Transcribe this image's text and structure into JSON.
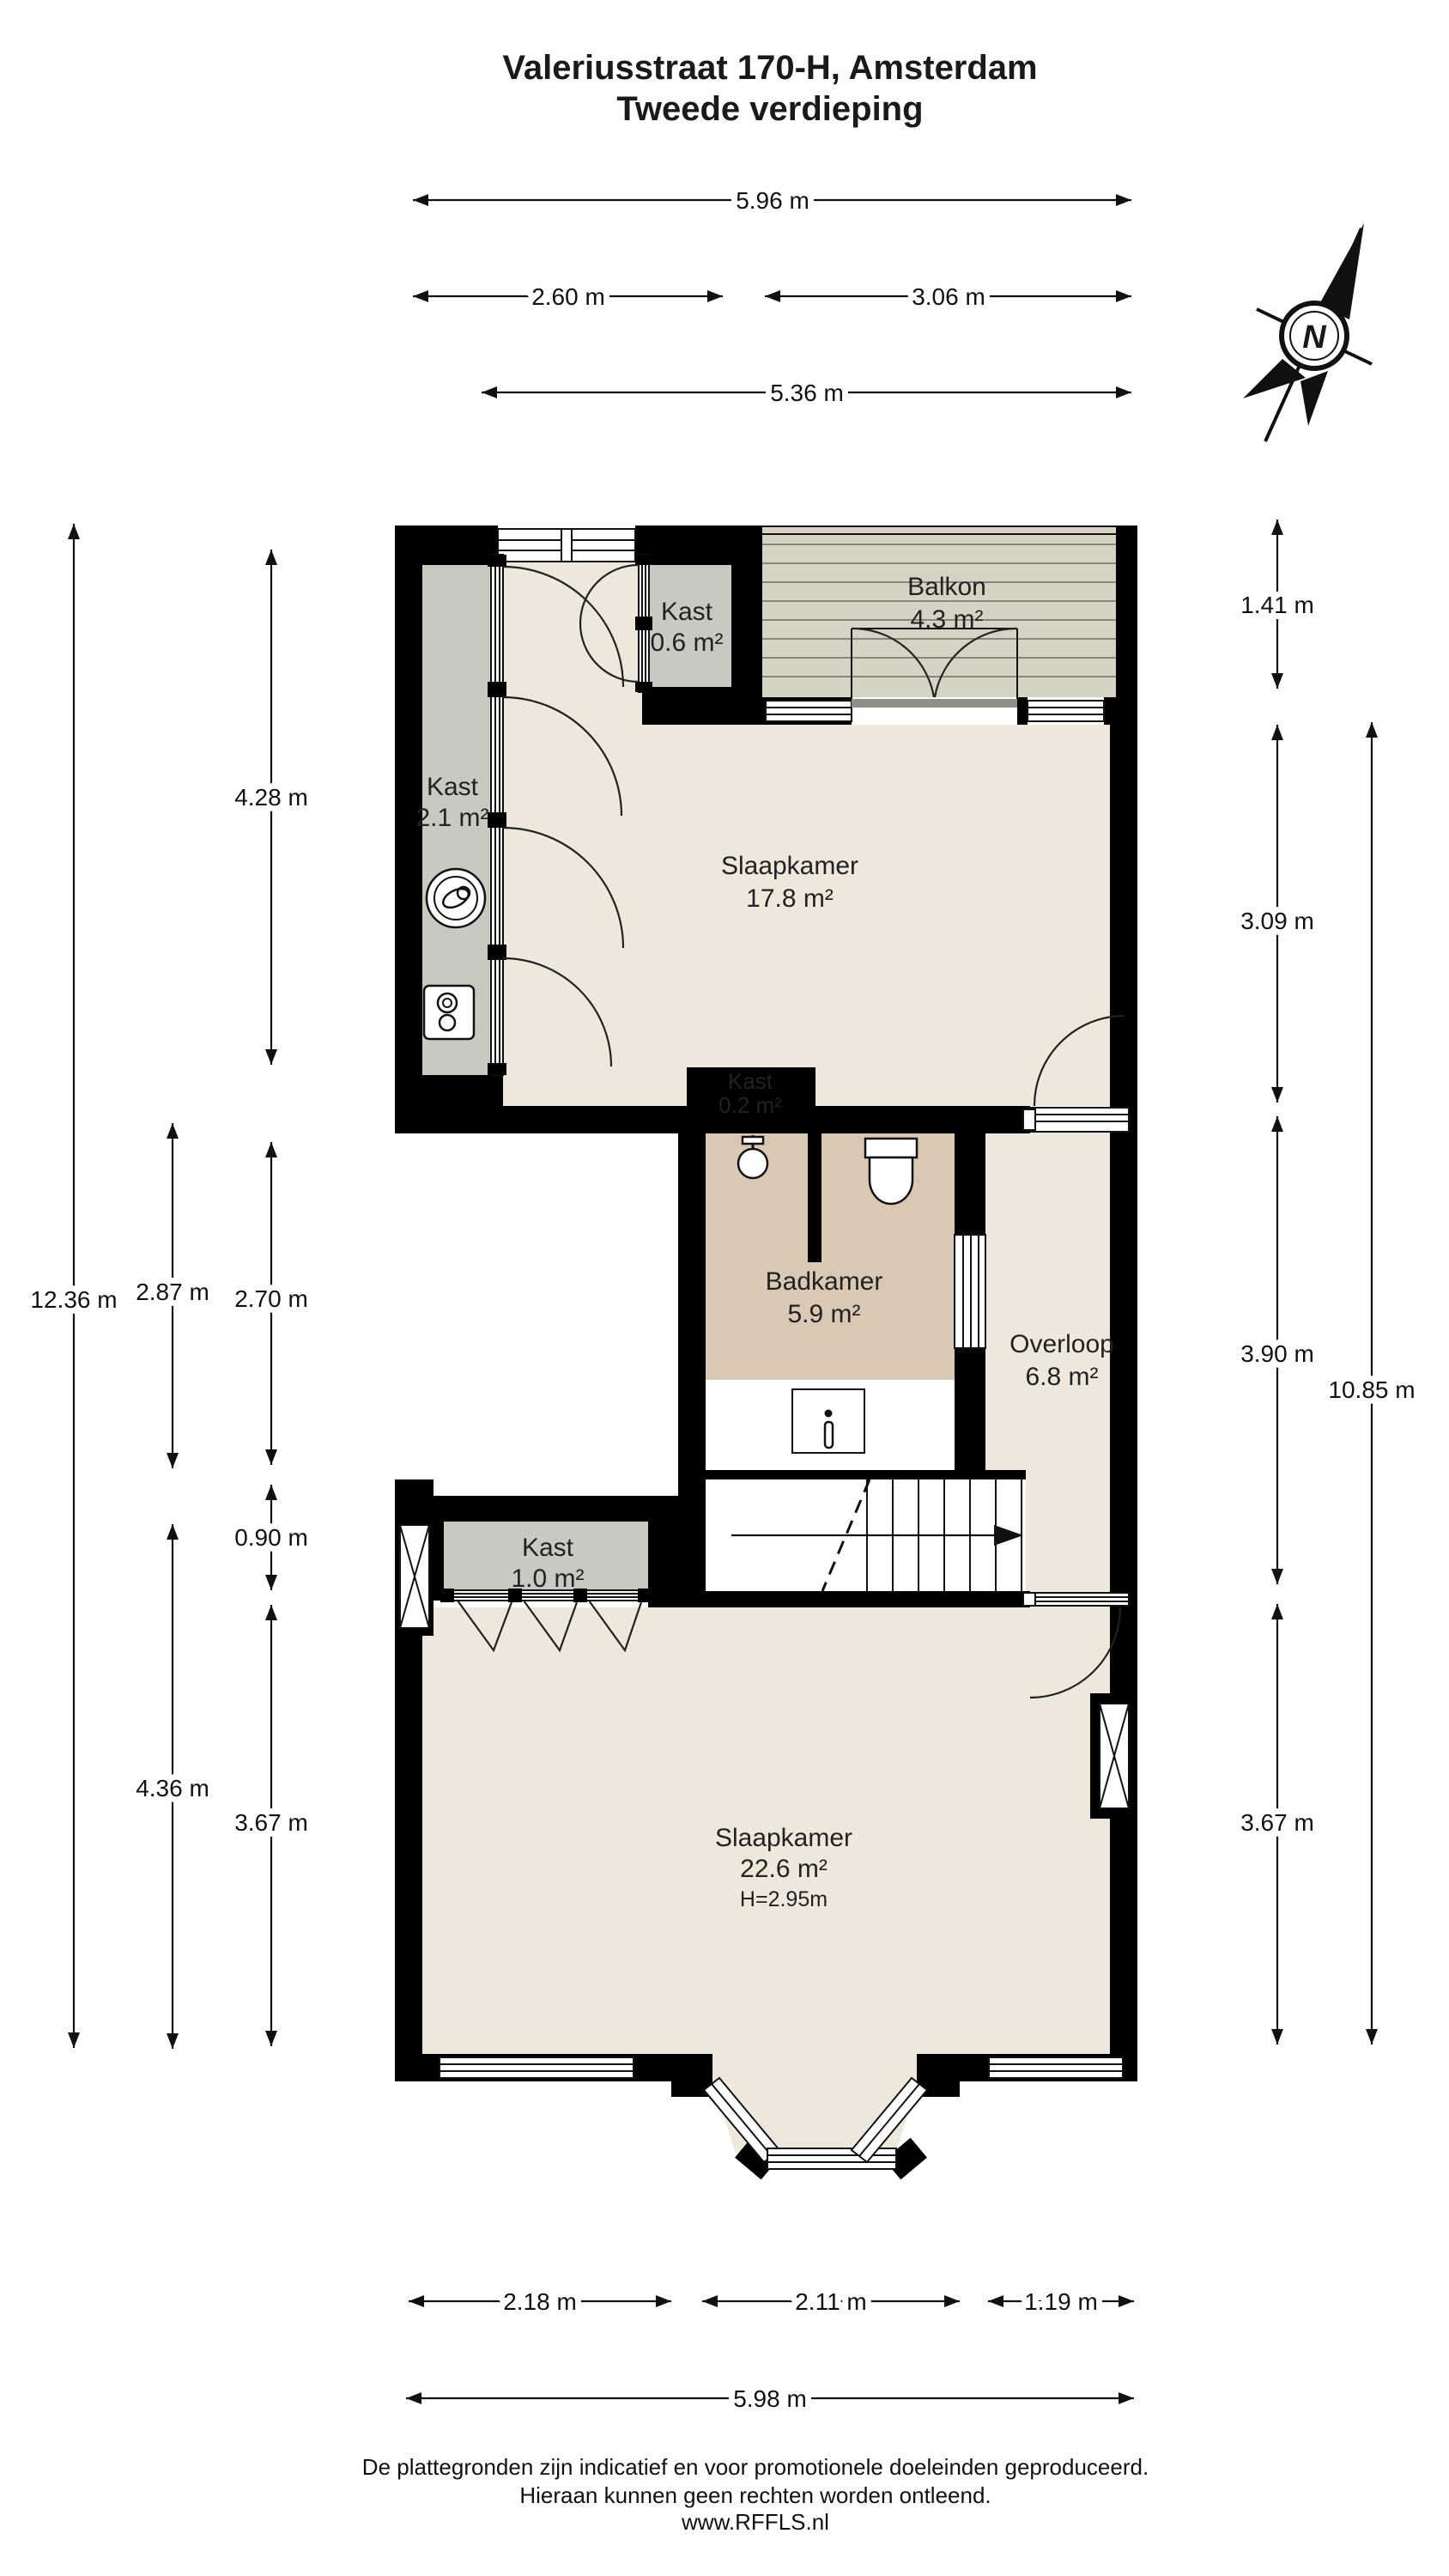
{
  "title": {
    "line1": "Valeriusstraat 170-H, Amsterdam",
    "line2": "Tweede verdieping"
  },
  "compass": {
    "label": "N"
  },
  "rooms": {
    "kast06": {
      "name": "Kast",
      "area": "0.6 m²"
    },
    "balkon": {
      "name": "Balkon",
      "area": "4.3 m²"
    },
    "kast21": {
      "name": "Kast",
      "area": "2.1 m²"
    },
    "slaapkamer1": {
      "name": "Slaapkamer",
      "area": "17.8 m²"
    },
    "kast02": {
      "name": "Kast",
      "area": "0.2 m²"
    },
    "badkamer": {
      "name": "Badkamer",
      "area": "5.9 m²"
    },
    "overloop": {
      "name": "Overloop",
      "area": "6.8 m²"
    },
    "kast10": {
      "name": "Kast",
      "area": "1.0 m²"
    },
    "slaapkamer2": {
      "name": "Slaapkamer",
      "area": "22.6 m²",
      "height": "H=2.95m"
    }
  },
  "dimensions": {
    "top": [
      "5.96 m",
      "2.60 m",
      "3.06 m",
      "5.36 m"
    ],
    "left": [
      "12.36 m",
      "4.28 m",
      "2.87 m",
      "2.70 m",
      "0.90 m",
      "4.36 m",
      "3.67 m"
    ],
    "right": [
      "1.41 m",
      "3.09 m",
      "3.90 m",
      "10.85 m",
      "3.67 m"
    ],
    "bottom": [
      "2.18 m",
      "2.11 m",
      "1.19 m",
      "5.98 m"
    ]
  },
  "footer": {
    "line1": "De plattegronden zijn indicatief en voor promotionele doeleinden geproduceerd.",
    "line2": "Hieraan kunnen geen rechten worden ontleend.",
    "line3": "www.RFFLS.nl"
  },
  "colors": {
    "wall": "#000000",
    "floor": "#EDE8DB",
    "closet": "#C7CAC1",
    "bathroom": "#D9C9B4",
    "balcony": "#D6D3C5",
    "white": "#FFFFFF"
  }
}
